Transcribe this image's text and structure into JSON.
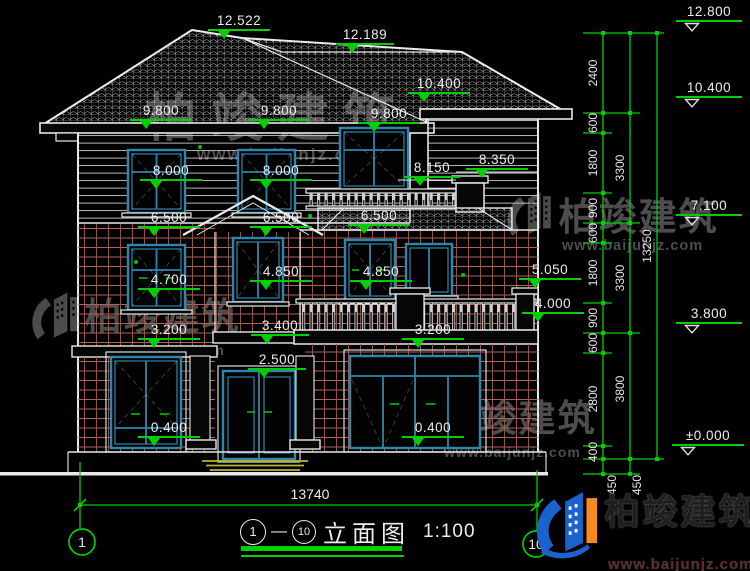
{
  "title_block": {
    "axis_start": "1",
    "separator": "—",
    "axis_end": "10",
    "drawing_name": "立面图",
    "scale": "1:100"
  },
  "axis_bubbles": {
    "left": "1",
    "right": "10"
  },
  "overall_width_dim": "13740",
  "levels": {
    "l12522": "12.522",
    "l12189": "12.189",
    "l10400_roof": "10.400",
    "l9800_a": "9.800",
    "l9800_b": "9.800",
    "l9800_c": "9.800",
    "l8000_a": "8.000",
    "l8000_b": "8.000",
    "l8150": "8.150",
    "l8350": "8.350",
    "l6500_a": "6.500",
    "l6500_b": "6.500",
    "l6500_c": "6.500",
    "l4700": "4.700",
    "l4850_a": "4.850",
    "l4850_b": "4.850",
    "l5050": "5.050",
    "l4000": "4.000",
    "l3400": "3.400",
    "l3200_a": "3.200",
    "l3200_b": "3.200",
    "l2500": "2.500",
    "l0400_a": "0.400",
    "l0400_b": "0.400",
    "r12800": "12.800",
    "r10400": "10.400",
    "r7100": "7.100",
    "r3800": "3.800",
    "r0000": "±0.000"
  },
  "dim_chains": {
    "inner": [
      "2400",
      "600",
      "1800",
      "900",
      "600",
      "1800",
      "900",
      "600",
      "2800",
      "400",
      "450"
    ],
    "middle": [
      "3300",
      "3300",
      "3800",
      "450"
    ],
    "outer": [
      "13250"
    ]
  },
  "watermark": {
    "brand": "柏竣建筑",
    "url": "www.baijunjz.com"
  },
  "logo": {
    "brand": "柏竣建筑",
    "url": "www.baijunjz.com"
  },
  "colors": {
    "line": "#ececec",
    "dim_green": "#00cf00",
    "window_frame": "#2e86ad",
    "brick": "#b06255",
    "steps": "#b6b636",
    "logo_blue": "#1a63cc",
    "logo_orange": "#f78c1e"
  }
}
